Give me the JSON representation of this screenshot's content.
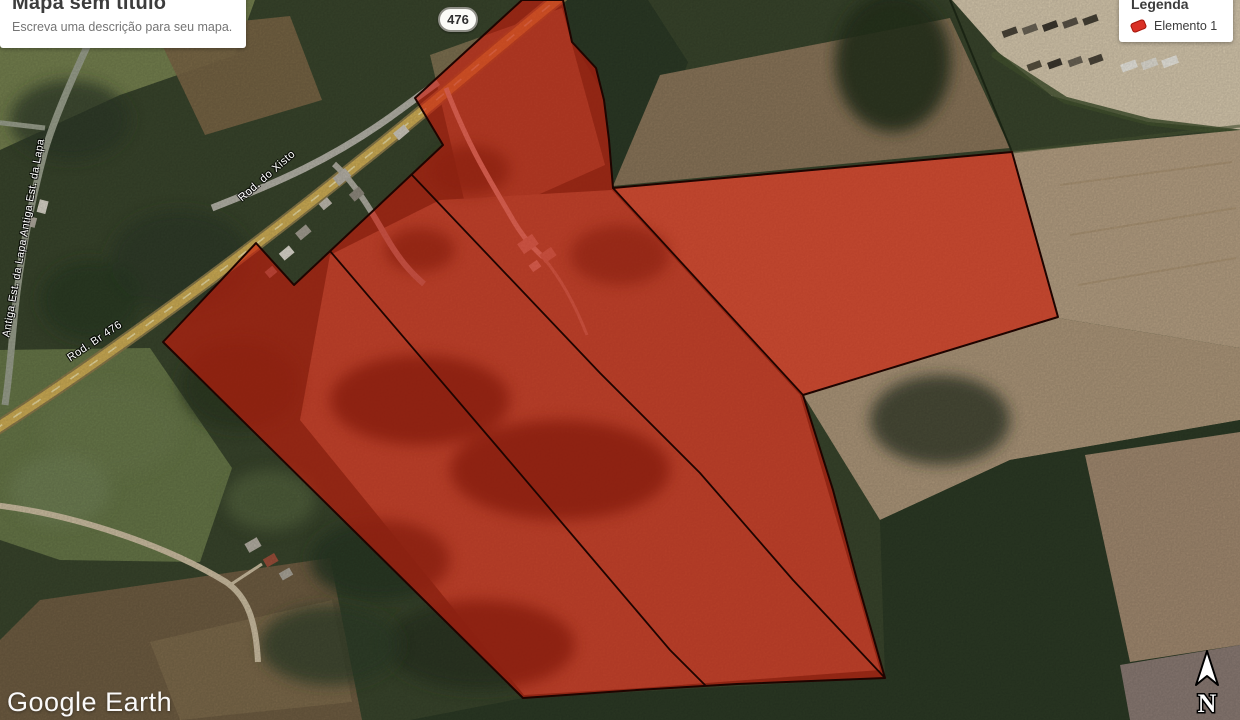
{
  "title_panel": {
    "title": "Mapa sem título",
    "subtitle": "Escreva uma descrição para seu mapa."
  },
  "legend": {
    "header": "Legenda",
    "items": [
      {
        "label": "Elemento 1",
        "color": "#d93025"
      }
    ]
  },
  "map_labels": {
    "route_badge": "476",
    "roads": [
      {
        "name": "rod-do-xisto",
        "text": "Rod. do Xisto"
      },
      {
        "name": "rod-br-476",
        "text": "Rod. Br 476"
      },
      {
        "name": "antiga-est-da-lapa",
        "text": "Antiga Est. da Lapa Antiga Est. da Lapa"
      }
    ],
    "north": "N"
  },
  "watermark": "Google Earth",
  "overlay": {
    "element": "Elemento 1",
    "fill": "#d01708",
    "outline": "#1e0400"
  }
}
